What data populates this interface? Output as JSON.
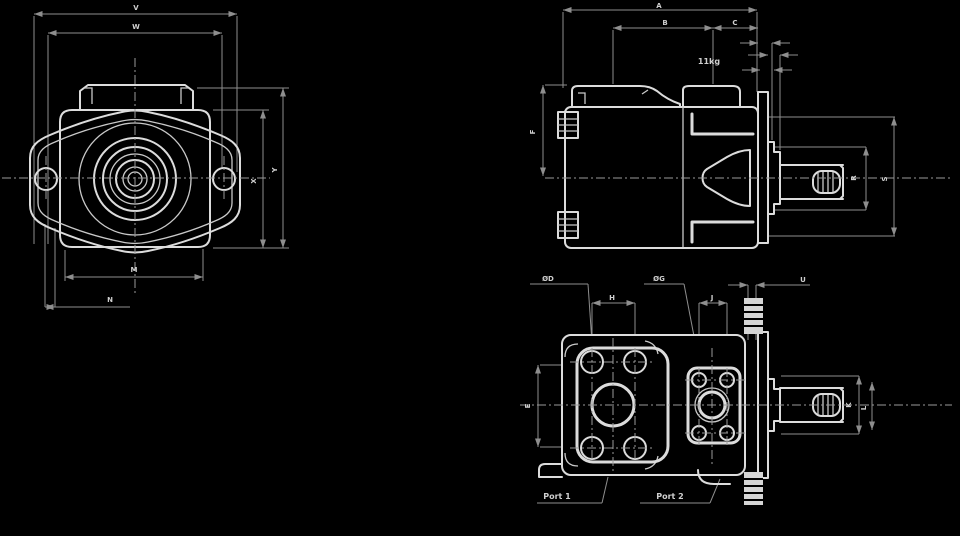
{
  "drawing": {
    "title": "hydraulic-vane-pump-dimensional-drawing",
    "background_color": "#000000",
    "outline_color": "#dcdcdc",
    "dimension_line_color": "#8e8e8e",
    "text_color": "#cfcfcf",
    "mass_note": "11kg",
    "port_labels": {
      "left": "Port 1",
      "right": "Port 2"
    }
  },
  "labels": [
    {
      "text": "V",
      "x": 136,
      "y": 10,
      "s": 7
    },
    {
      "text": "W",
      "x": 136,
      "y": 29,
      "s": 7
    },
    {
      "text": "X",
      "x": 256,
      "y": 181,
      "s": 7,
      "rot": 1
    },
    {
      "text": "Y",
      "x": 277,
      "y": 170,
      "s": 7,
      "rot": 1
    },
    {
      "text": "M",
      "x": 134,
      "y": 272,
      "s": 7
    },
    {
      "text": "N",
      "x": 110,
      "y": 302,
      "s": 7
    },
    {
      "text": "A",
      "x": 659,
      "y": 8,
      "s": 7
    },
    {
      "text": "B",
      "x": 665,
      "y": 25,
      "s": 7
    },
    {
      "text": "C",
      "x": 735,
      "y": 25,
      "s": 7
    },
    {
      "text": "11kg",
      "x": 709,
      "y": 64,
      "s": 8
    },
    {
      "text": "F",
      "x": 535,
      "y": 132,
      "s": 7,
      "rot": 1
    },
    {
      "text": "R",
      "x": 856,
      "y": 178,
      "s": 7,
      "rot": 1
    },
    {
      "text": "S",
      "x": 887,
      "y": 179,
      "s": 7,
      "rot": 1
    },
    {
      "text": "ØD",
      "x": 548,
      "y": 281,
      "s": 7
    },
    {
      "text": "ØG",
      "x": 659,
      "y": 281,
      "s": 7
    },
    {
      "text": "H",
      "x": 612,
      "y": 300,
      "s": 7
    },
    {
      "text": "J",
      "x": 712,
      "y": 300,
      "s": 7
    },
    {
      "text": "U",
      "x": 803,
      "y": 282,
      "s": 7
    },
    {
      "text": "E",
      "x": 530,
      "y": 406,
      "s": 7,
      "rot": 1
    },
    {
      "text": "K",
      "x": 851,
      "y": 405,
      "s": 7,
      "rot": 1
    },
    {
      "text": "L",
      "x": 866,
      "y": 408,
      "s": 7,
      "rot": 1
    },
    {
      "text": "Port 1",
      "x": 557,
      "y": 499,
      "s": 8
    },
    {
      "text": "Port 2",
      "x": 670,
      "y": 499,
      "s": 8
    }
  ]
}
